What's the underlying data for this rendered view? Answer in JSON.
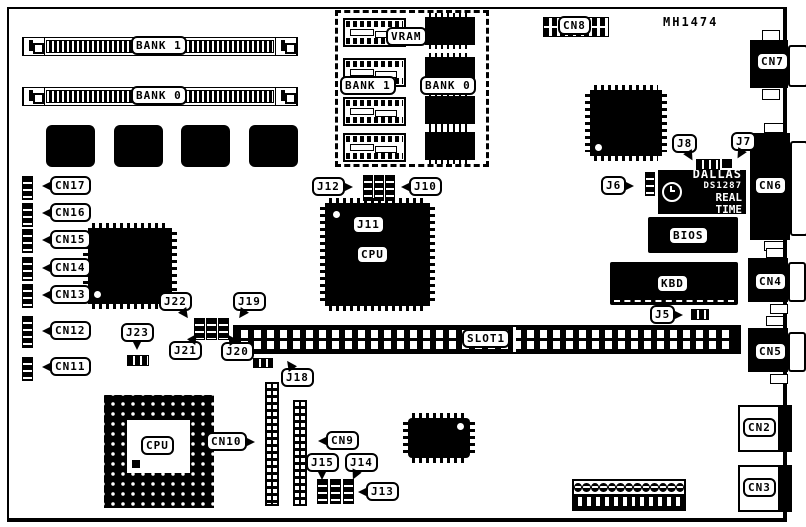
{
  "meta": {
    "part_number": "MH1474"
  },
  "memory_slots": {
    "bank1": "BANK 1",
    "bank0": "BANK 0"
  },
  "vram_area": {
    "title": "VRAM",
    "bank1": "BANK 1",
    "bank0": "BANK 0"
  },
  "chips": {
    "cpu_qfp": "CPU",
    "cpu_pga": "CPU",
    "bios": "BIOS",
    "kbd": "KBD",
    "rtc_brand": "DALLAS",
    "rtc_model": "DS1287",
    "rtc_type": "REAL TIME"
  },
  "slot": "SLOT1",
  "connectors": {
    "cn2": "CN2",
    "cn3": "CN3",
    "cn4": "CN4",
    "cn5": "CN5",
    "cn6": "CN6",
    "cn7": "CN7",
    "cn8": "CN8",
    "cn9": "CN9",
    "cn10": "CN10",
    "cn11": "CN11",
    "cn12": "CN12",
    "cn13": "CN13",
    "cn14": "CN14",
    "cn15": "CN15",
    "cn16": "CN16",
    "cn17": "CN17"
  },
  "jumpers": {
    "j5": "J5",
    "j6": "J6",
    "j7": "J7",
    "j8": "J8",
    "j10": "J10",
    "j11": "J11",
    "j12": "J12",
    "j13": "J13",
    "j14": "J14",
    "j15": "J15",
    "j18": "J18",
    "j19": "J19",
    "j20": "J20",
    "j21": "J21",
    "j22": "J22",
    "j23": "J23"
  }
}
